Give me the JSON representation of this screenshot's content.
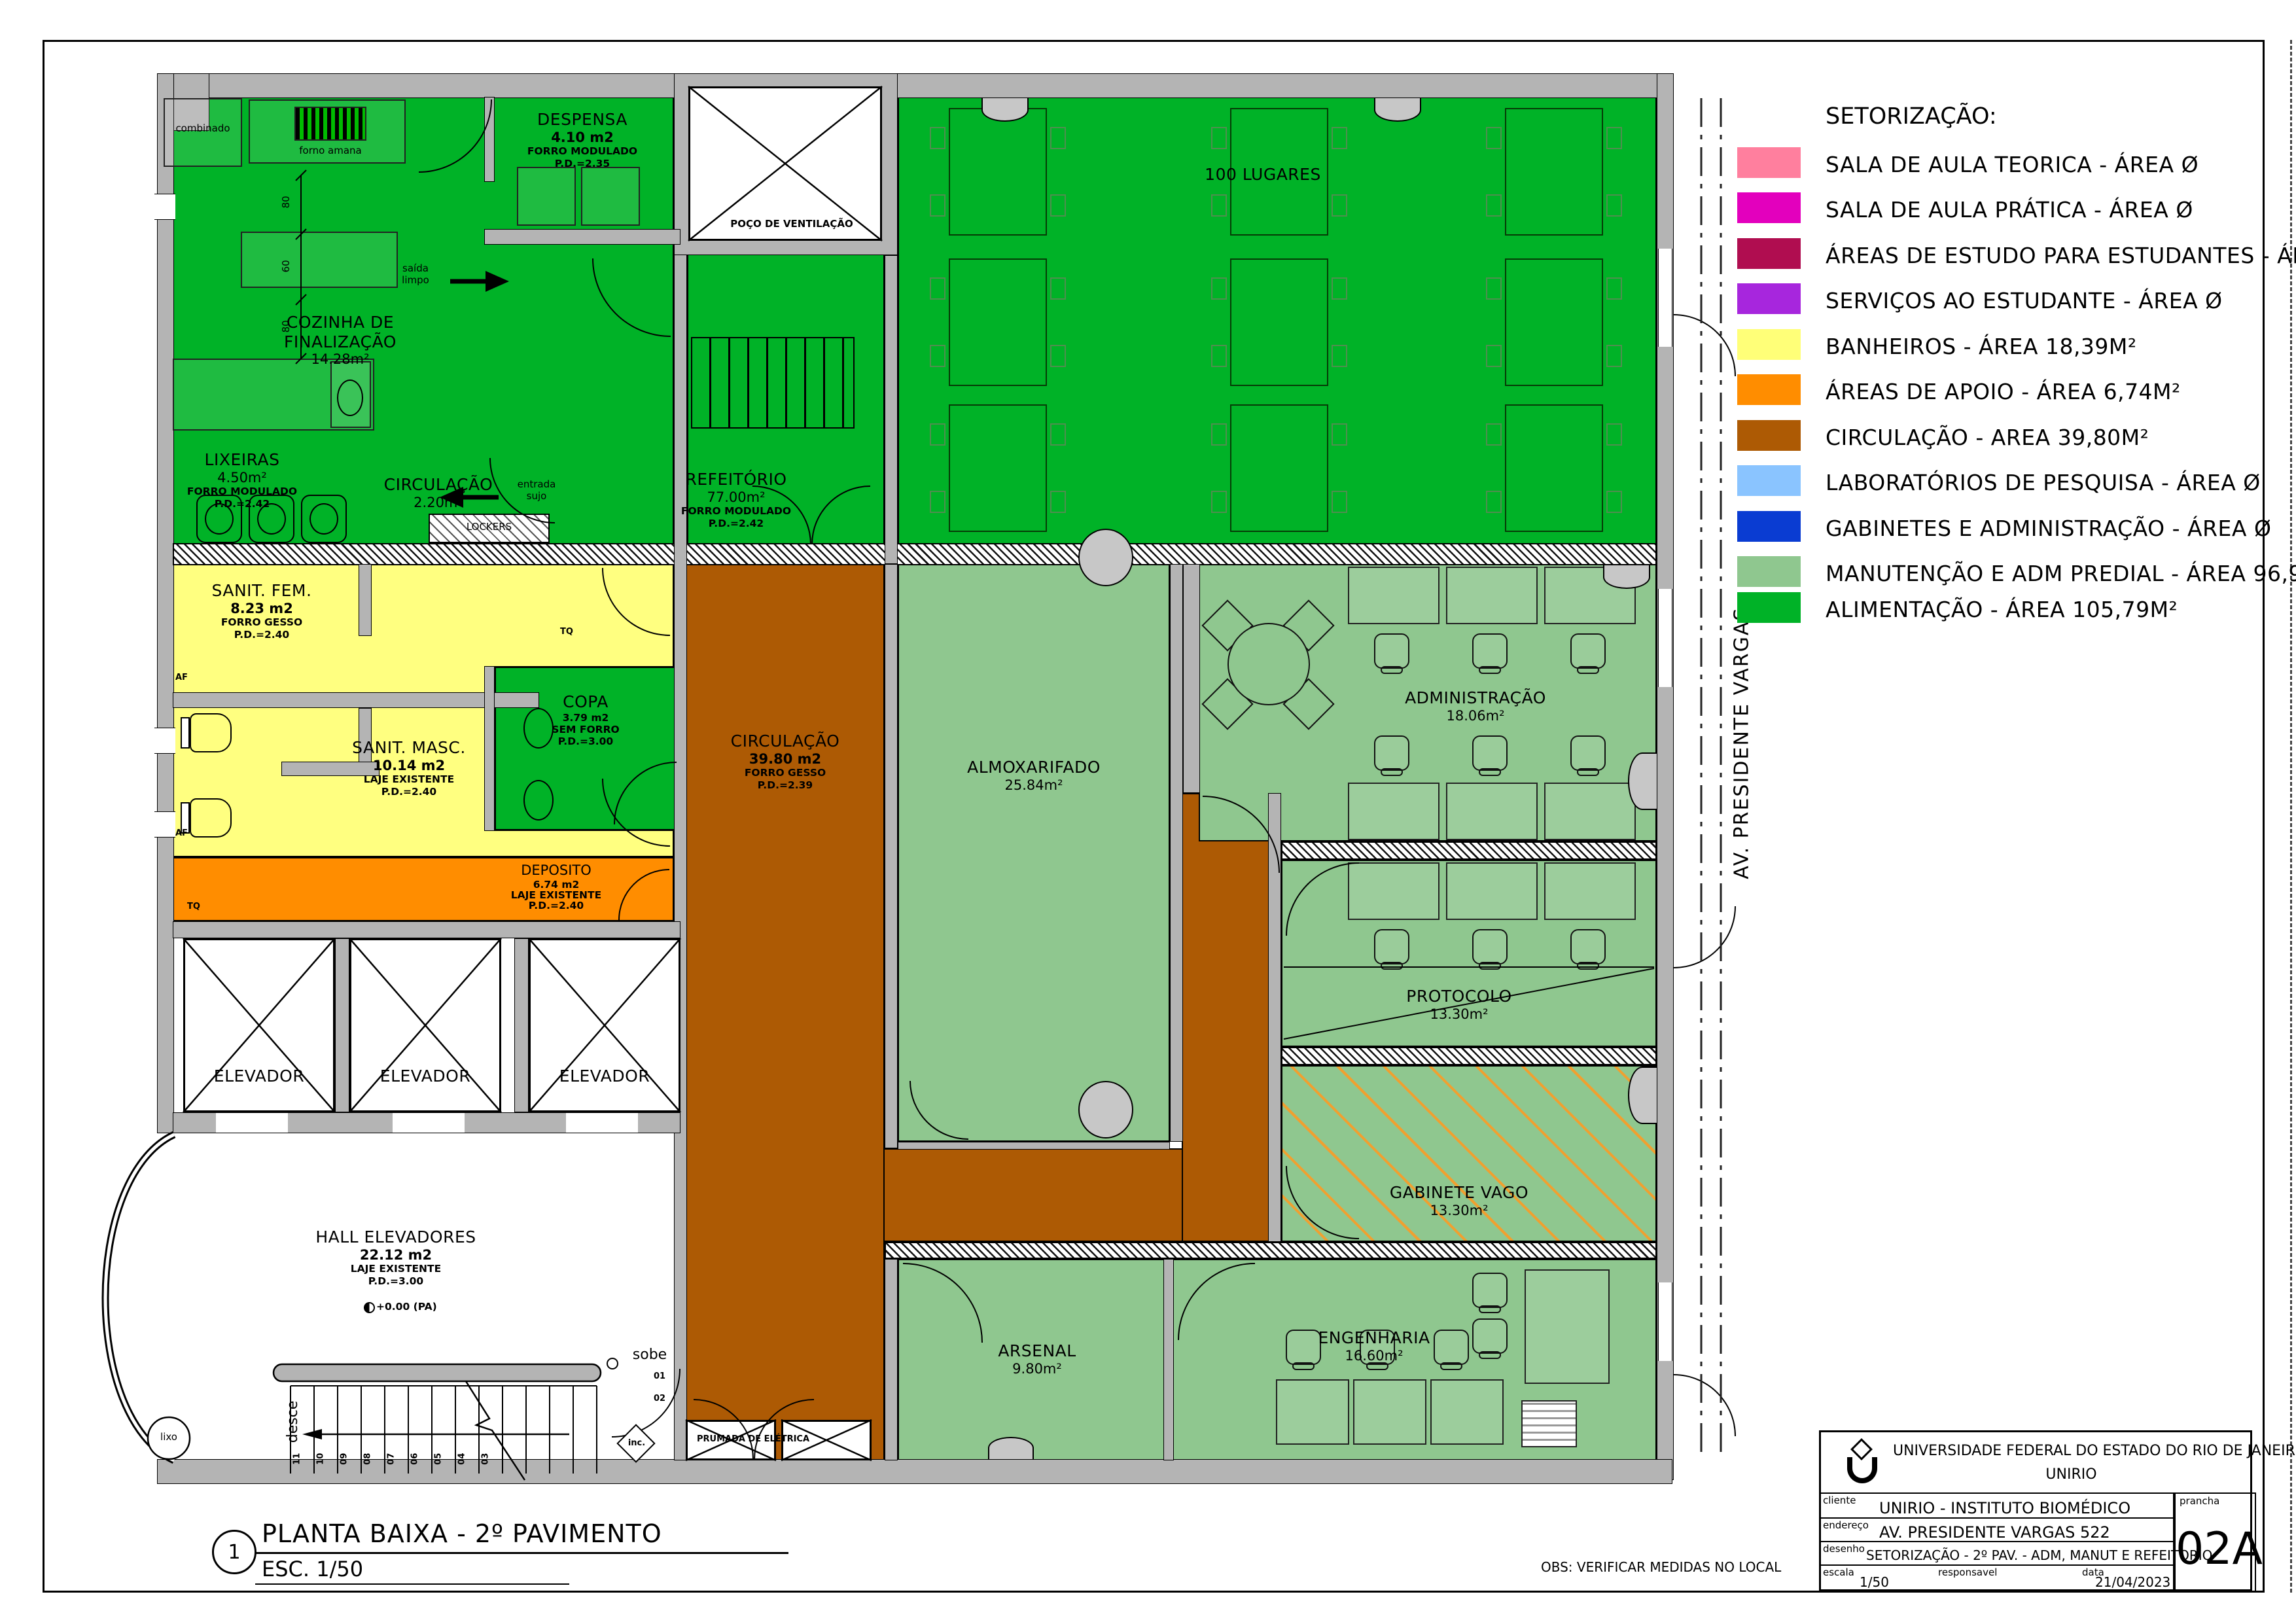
{
  "legend": {
    "title": "SETORIZAÇÃO:",
    "items": [
      {
        "label": "SALA DE AULA TEORICA - ÁREA Ø",
        "color": "#ff7f9e"
      },
      {
        "label": "SALA DE AULA PRÁTICA - ÁREA Ø",
        "color": "#e300bd"
      },
      {
        "label": "ÁREAS DE ESTUDO PARA ESTUDANTES - ÁREA Ø",
        "color": "#b00d50"
      },
      {
        "label": "SERVIÇOS AO ESTUDANTE - ÁREA Ø",
        "color": "#a726dd"
      },
      {
        "label": "BANHEIROS - ÁREA 18,39M²",
        "color": "#ffff78"
      },
      {
        "label": "ÁREAS DE APOIO - ÁREA 6,74M²",
        "color": "#ff8d00"
      },
      {
        "label": "CIRCULAÇÃO - AREA 39,80M²",
        "color": "#ad5a04"
      },
      {
        "label": "LABORATÓRIOS DE PESQUISA - ÁREA Ø",
        "color": "#8ac4ff"
      },
      {
        "label": "GABINETES E ADMINISTRAÇÃO - ÁREA Ø",
        "color": "#0a3cd2"
      },
      {
        "label": "MANUTENÇÃO E ADM PREDIAL - ÁREA 96,90M²",
        "color": "#8fc78f"
      },
      {
        "label": "ALIMENTAÇÃO - ÁREA 105,79M²",
        "color": "#00b227"
      }
    ]
  },
  "plan": {
    "street_label": "AV. PRESIDENTE VARGAS",
    "poco_label": "POÇO DE VENTILAÇÃO",
    "seats_label": "100 LUGARES",
    "elevador_label": "ELEVADOR",
    "rooms": {
      "despensa": [
        "DESPENSA",
        "4.10 m2",
        "FORRO MODULADO",
        "P.D.=2.35"
      ],
      "cozinha": [
        "COZINHA DE",
        "FINALIZAÇÃO",
        "14.28m²"
      ],
      "lixeiras": [
        "LIXEIRAS",
        "4.50m²",
        "FORRO MODULADO",
        "P.D.=2.42"
      ],
      "circ_cozinha": [
        "CIRCULAÇÃO",
        "2.20m²"
      ],
      "refeitorio": [
        "REFEITÓRIO",
        "77.00m²",
        "FORRO MODULADO",
        "P.D.=2.42"
      ],
      "sanit_fem": [
        "SANIT. FEM.",
        "8.23 m2",
        "FORRO GESSO",
        "P.D.=2.40"
      ],
      "sanit_masc": [
        "SANIT. MASC.",
        "10.14 m2",
        "LAJE EXISTENTE",
        "P.D.=2.40"
      ],
      "copa": [
        "COPA",
        "3.79 m2",
        "SEM FORRO",
        "P.D.=3.00"
      ],
      "deposito": [
        "DEPOSITO",
        "6.74 m2",
        "LAJE EXISTENTE",
        "P.D.=2.40"
      ],
      "hall": [
        "HALL ELEVADORES",
        "22.12 m2",
        "LAJE EXISTENTE",
        "P.D.=3.00"
      ],
      "circulacao": [
        "CIRCULAÇÃO",
        "39.80 m2",
        "FORRO GESSO",
        "P.D.=2.39"
      ],
      "almoxarifado": [
        "ALMOXARIFADO",
        "25.84m²"
      ],
      "administracao": [
        "ADMINISTRAÇÃO",
        "18.06m²"
      ],
      "protocolo": [
        "PROTOCOLO",
        "13.30m²"
      ],
      "gabinete": [
        "GABINETE VAGO",
        "13.30m²"
      ],
      "arsenal": [
        "ARSENAL",
        "9.80m²"
      ],
      "engenharia": [
        "ENGENHARIA",
        "16.60m²"
      ]
    },
    "annotations": {
      "combinado": "combinado",
      "forno": "forno amana",
      "saida_l1": "saída",
      "saida_l2": "limpo",
      "entrada_l1": "entrada",
      "entrada_l2": "sujo",
      "lockers": "LOCKERS",
      "prumada": "PRUMADA DE ELÉTRICA",
      "sobe": "sobe",
      "desce": "desce",
      "lixo": "lixo",
      "inc": "inc.",
      "level": "+0.00 (PA)",
      "af": "AF",
      "tq": "TQ",
      "dim80": "80",
      "dim60": "60",
      "s01": "01",
      "s02": "02",
      "steps": [
        "11",
        "10",
        "09",
        "08",
        "07",
        "06",
        "05",
        "04",
        "03"
      ]
    }
  },
  "title_block": {
    "org1": "UNIVERSIDADE FEDERAL DO ESTADO DO RIO DE JANEIRO",
    "org2": "UNIRIO",
    "cliente_label": "cliente",
    "cliente": "UNIRIO - INSTITUTO BIOMÉDICO",
    "endereco_label": "endereço",
    "endereco": "AV. PRESIDENTE VARGAS 522",
    "desenho_label": "desenho",
    "desenho": "SETORIZAÇÃO - 2º PAV. - ADM, MANUT E REFEITORIO",
    "escala_label": "escala",
    "escala": "1/50",
    "responsavel_label": "responsavel",
    "data_label": "data",
    "data": "21/04/2023",
    "prancha_label": "prancha",
    "prancha": "02A"
  },
  "footer": {
    "num": "1",
    "title": "PLANTA BAIXA - 2º PAVIMENTO",
    "esc": "ESC. 1/50",
    "obs": "OBS: VERIFICAR MEDIDAS NO LOCAL"
  }
}
